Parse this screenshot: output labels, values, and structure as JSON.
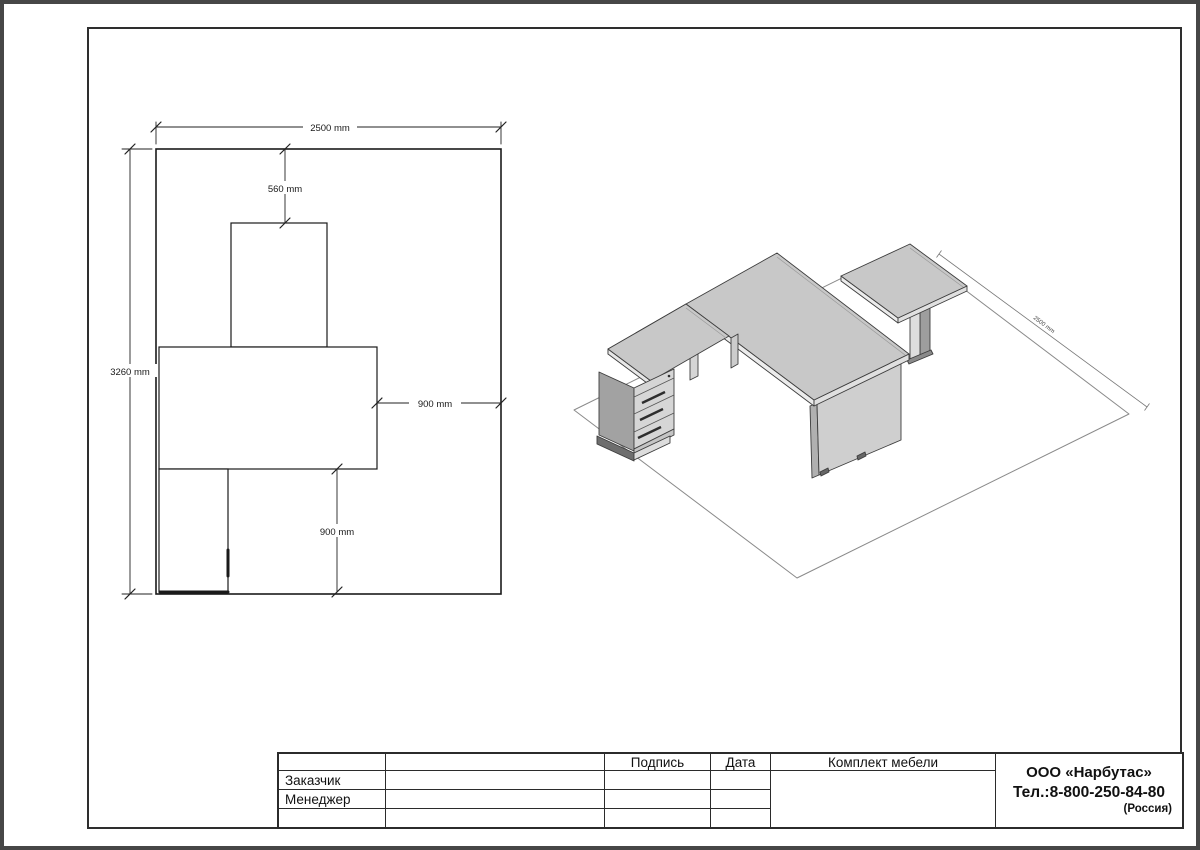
{
  "plan": {
    "dims": {
      "width_top": "2500 mm",
      "offset_top": "560 mm",
      "depth_left": "3260 mm",
      "clearance_right": "900 mm",
      "clearance_bottom": "900 mm"
    }
  },
  "iso": {
    "dims": {
      "floor_width": "2500 mm"
    }
  },
  "title_block": {
    "columns": {
      "signature": "Подпись",
      "date": "Дата"
    },
    "rows": [
      {
        "label": "Заказчик"
      },
      {
        "label": "Менеджер"
      }
    ],
    "document_title": "Комплект мебели",
    "company": {
      "name": "ООО «Нарбутас»",
      "phone": "Тел.:8-800-250-84-80",
      "country": "(Россия)"
    }
  },
  "colors": {
    "desk_top": "#c8c8c8",
    "desk_edge": "#e8e8e8",
    "pedestal_side": "#a2a2a2",
    "drawer_front": "#d6d6d6",
    "line": "#1a1a1a"
  }
}
